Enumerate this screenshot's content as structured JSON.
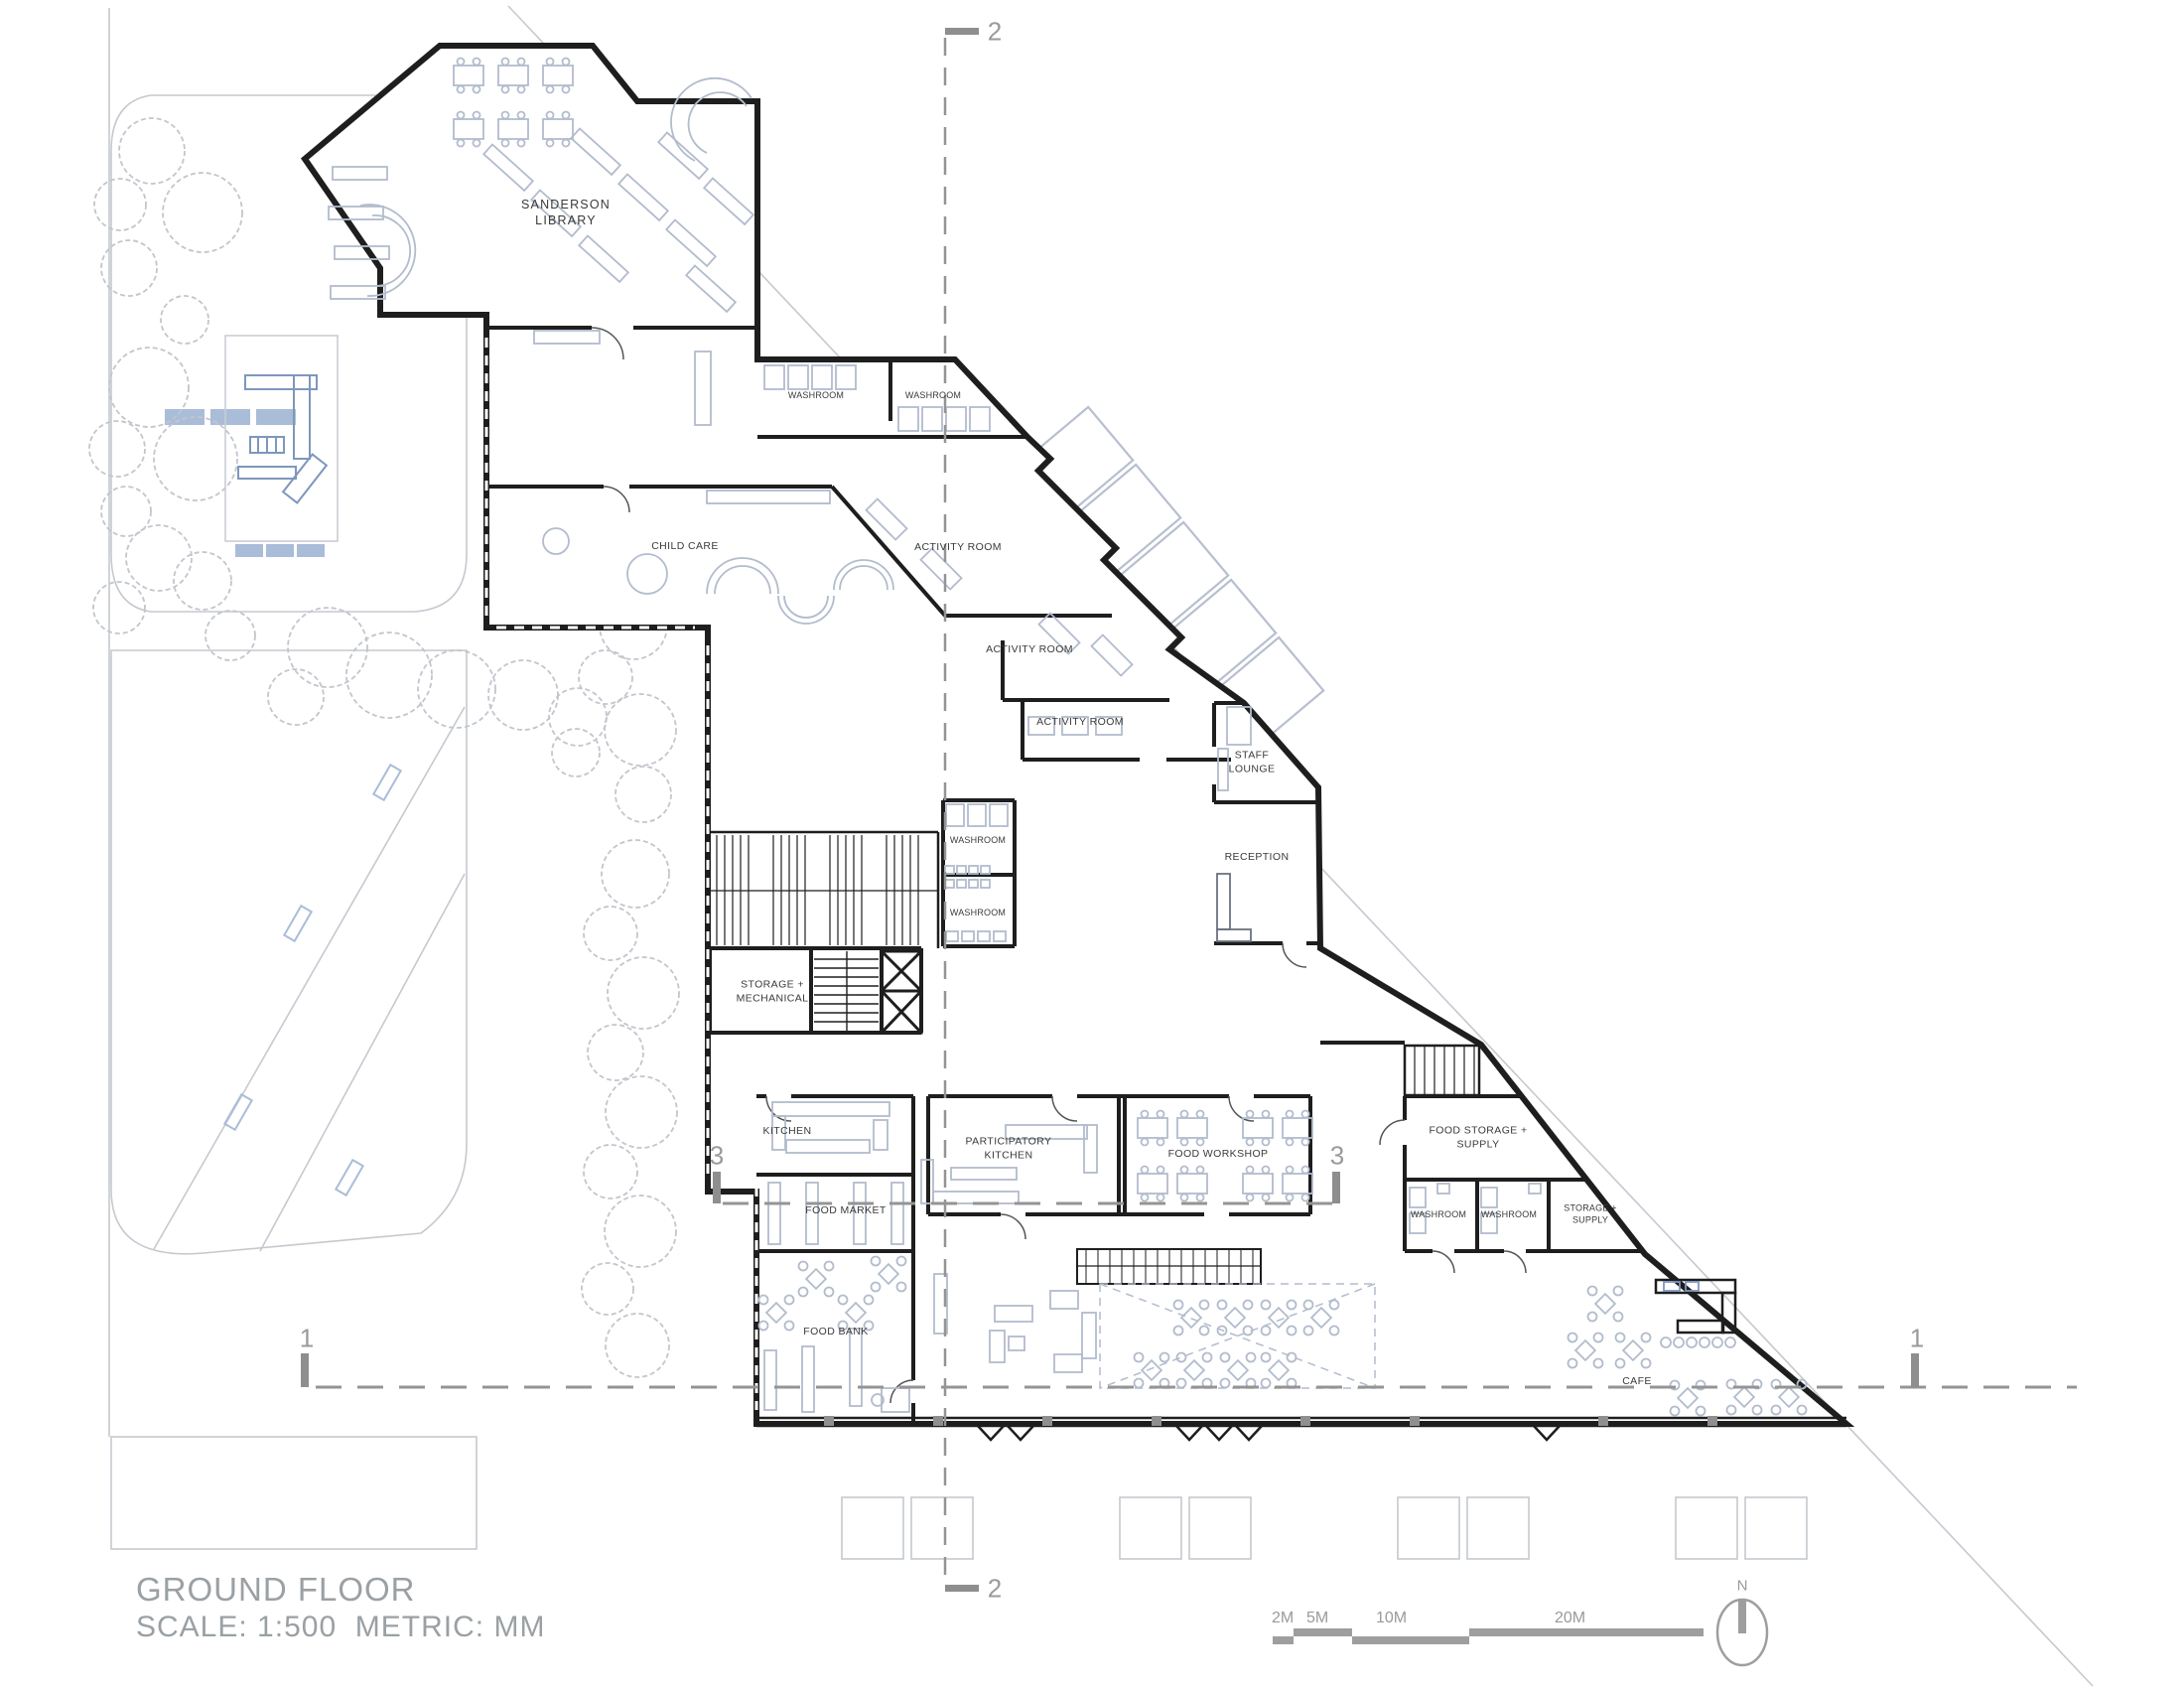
{
  "drawing": {
    "title": "GROUND FLOOR",
    "scale_note": "SCALE: 1:500  METRIC: MM"
  },
  "rooms": [
    {
      "id": "sanderson-library",
      "label": "SANDERSON\nLIBRARY"
    },
    {
      "id": "washroom-1",
      "label": "WASHROOM"
    },
    {
      "id": "washroom-2",
      "label": "WASHROOM"
    },
    {
      "id": "child-care",
      "label": "CHILD CARE"
    },
    {
      "id": "activity-room-1",
      "label": "ACTIVITY ROOM"
    },
    {
      "id": "activity-room-2",
      "label": "ACTIVITY ROOM"
    },
    {
      "id": "activity-room-3",
      "label": "ACTIVITY ROOM"
    },
    {
      "id": "staff-lounge",
      "label": "STAFF\nLOUNGE"
    },
    {
      "id": "reception",
      "label": "RECEPTION"
    },
    {
      "id": "washroom-3",
      "label": "WASHROOM"
    },
    {
      "id": "washroom-4",
      "label": "WASHROOM"
    },
    {
      "id": "storage-mechanical",
      "label": "STORAGE +\nMECHANICAL"
    },
    {
      "id": "kitchen",
      "label": "KITCHEN"
    },
    {
      "id": "participatory-kitchen",
      "label": "PARTICIPATORY\nKITCHEN"
    },
    {
      "id": "food-workshop",
      "label": "FOOD WORKSHOP"
    },
    {
      "id": "food-storage-supply",
      "label": "FOOD STORAGE +\nSUPPLY"
    },
    {
      "id": "washroom-5",
      "label": "WASHROOM"
    },
    {
      "id": "washroom-6",
      "label": "WASHROOM"
    },
    {
      "id": "storage-supply",
      "label": "STORAGE +\nSUPPLY"
    },
    {
      "id": "food-market",
      "label": "FOOD MARKET"
    },
    {
      "id": "food-bank",
      "label": "FOOD BANK"
    },
    {
      "id": "cafe",
      "label": "CAFE"
    }
  ],
  "sections": {
    "s1": {
      "label": "1"
    },
    "s2": {
      "label": "2"
    },
    "s3": {
      "label": "3"
    }
  },
  "scale_bar": {
    "labels": [
      "2M",
      "5M",
      "10M",
      "20M"
    ]
  },
  "north_arrow": {
    "label": "N"
  },
  "colors": {
    "wall": "#1e1e1e",
    "furniture": "#b2bccd",
    "site": "#c5c9cf",
    "annotation": "#9a9a9a",
    "play": "#7e97bd"
  }
}
